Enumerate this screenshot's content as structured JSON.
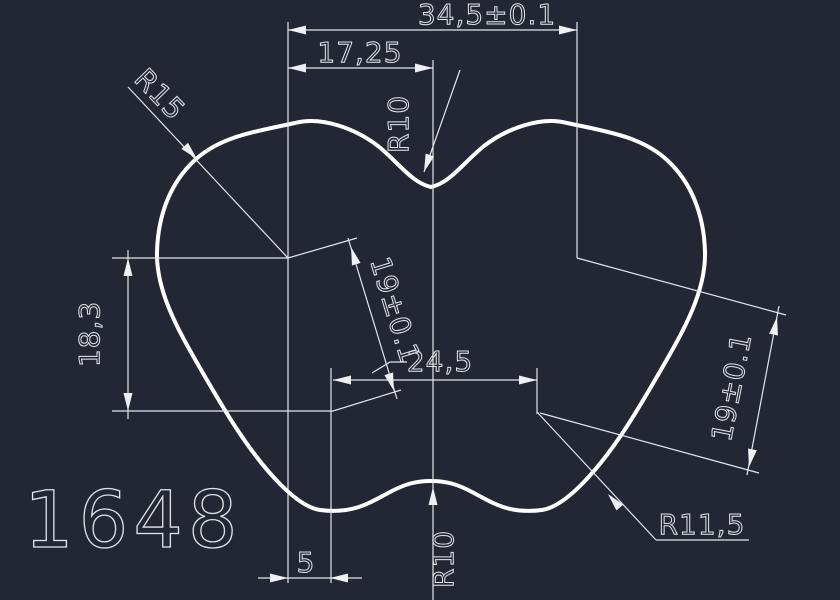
{
  "drawing": {
    "number": "1648",
    "type": "2d-profile-cad-drawing"
  },
  "colors": {
    "background": "#232733",
    "geometry": "#ffffff",
    "dimensions": "#e2e5e9"
  },
  "dims": {
    "width_total": "34,5±0.1",
    "width_half_left": "17,25",
    "radius_top_center": "R10",
    "radius_upper": "R15",
    "height_left": "18,3",
    "pitch_diagonal": "19±0.1",
    "width_bottom_centers": "24,5",
    "pitch_right": "19±0.1",
    "radius_lower": "R11,5",
    "radius_bottom_center": "R10",
    "offset_left_bottom": "5"
  }
}
